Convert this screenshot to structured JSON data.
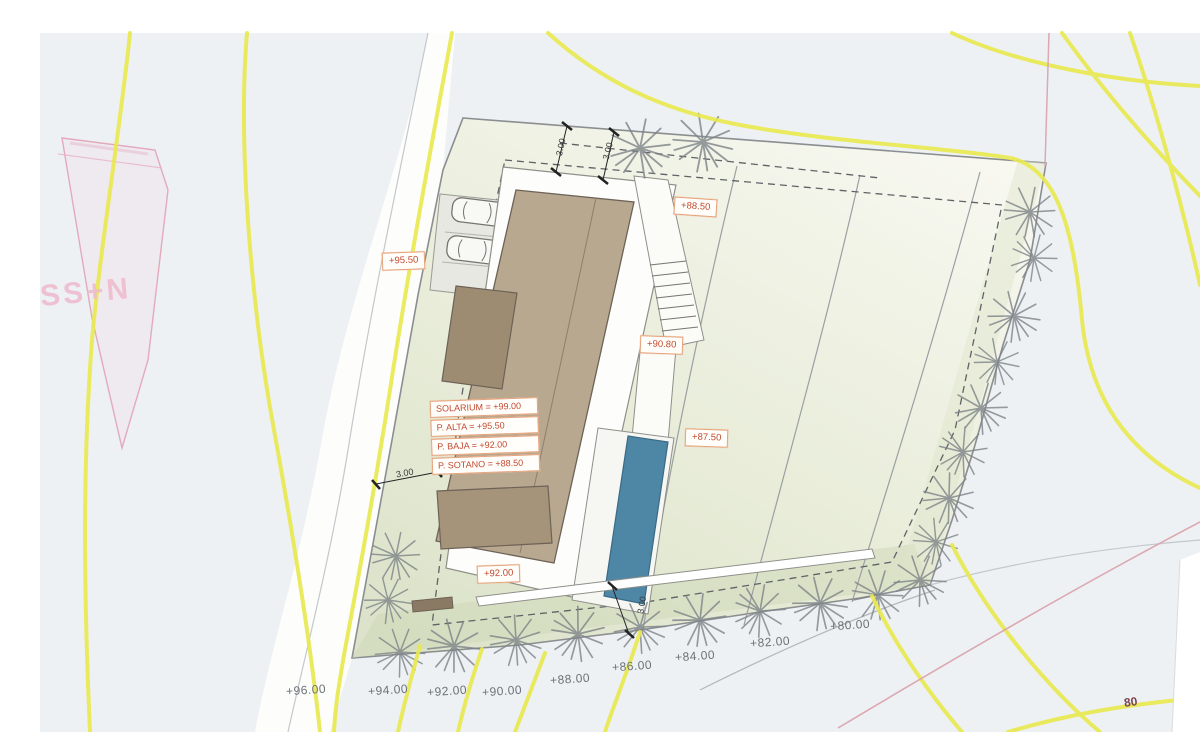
{
  "canvas": {
    "width": 1200,
    "height": 732,
    "type": "architectural site plan"
  },
  "labels": {
    "adjacent_parcel": "SS+N",
    "contour_inline": "80",
    "spot_elevations": [
      {
        "text": "+95.50"
      },
      {
        "text": "+88.50"
      },
      {
        "text": "+90.80"
      },
      {
        "text": "+87.50"
      },
      {
        "text": "+92.00"
      }
    ],
    "levels": [
      {
        "text": "SOLARIUM = +99.00"
      },
      {
        "text": "P. ALTA = +95.50"
      },
      {
        "text": "P. BAJA = +92.00"
      },
      {
        "text": "P. SOTANO = +88.50"
      }
    ],
    "contours": [
      {
        "text": "+96.00"
      },
      {
        "text": "+94.00"
      },
      {
        "text": "+92.00"
      },
      {
        "text": "+90.00"
      },
      {
        "text": "+88.00"
      },
      {
        "text": "+86.00"
      },
      {
        "text": "+84.00"
      },
      {
        "text": "+82.00"
      },
      {
        "text": "+80.00"
      }
    ],
    "dimensions": [
      {
        "text": "3.00"
      },
      {
        "text": "3.00"
      },
      {
        "text": "3.00"
      },
      {
        "text": "3.00"
      }
    ]
  },
  "colors": {
    "contour_line": "#e9e94e",
    "pool": "#4e86a5",
    "building": "#b8a88f",
    "building_dark": "#9d8b72",
    "label_text": "#c2492f",
    "label_border": "#e6a27a",
    "adjacent_parcel_line": "#e3aabc",
    "contour_label_text": "#6b7378"
  }
}
